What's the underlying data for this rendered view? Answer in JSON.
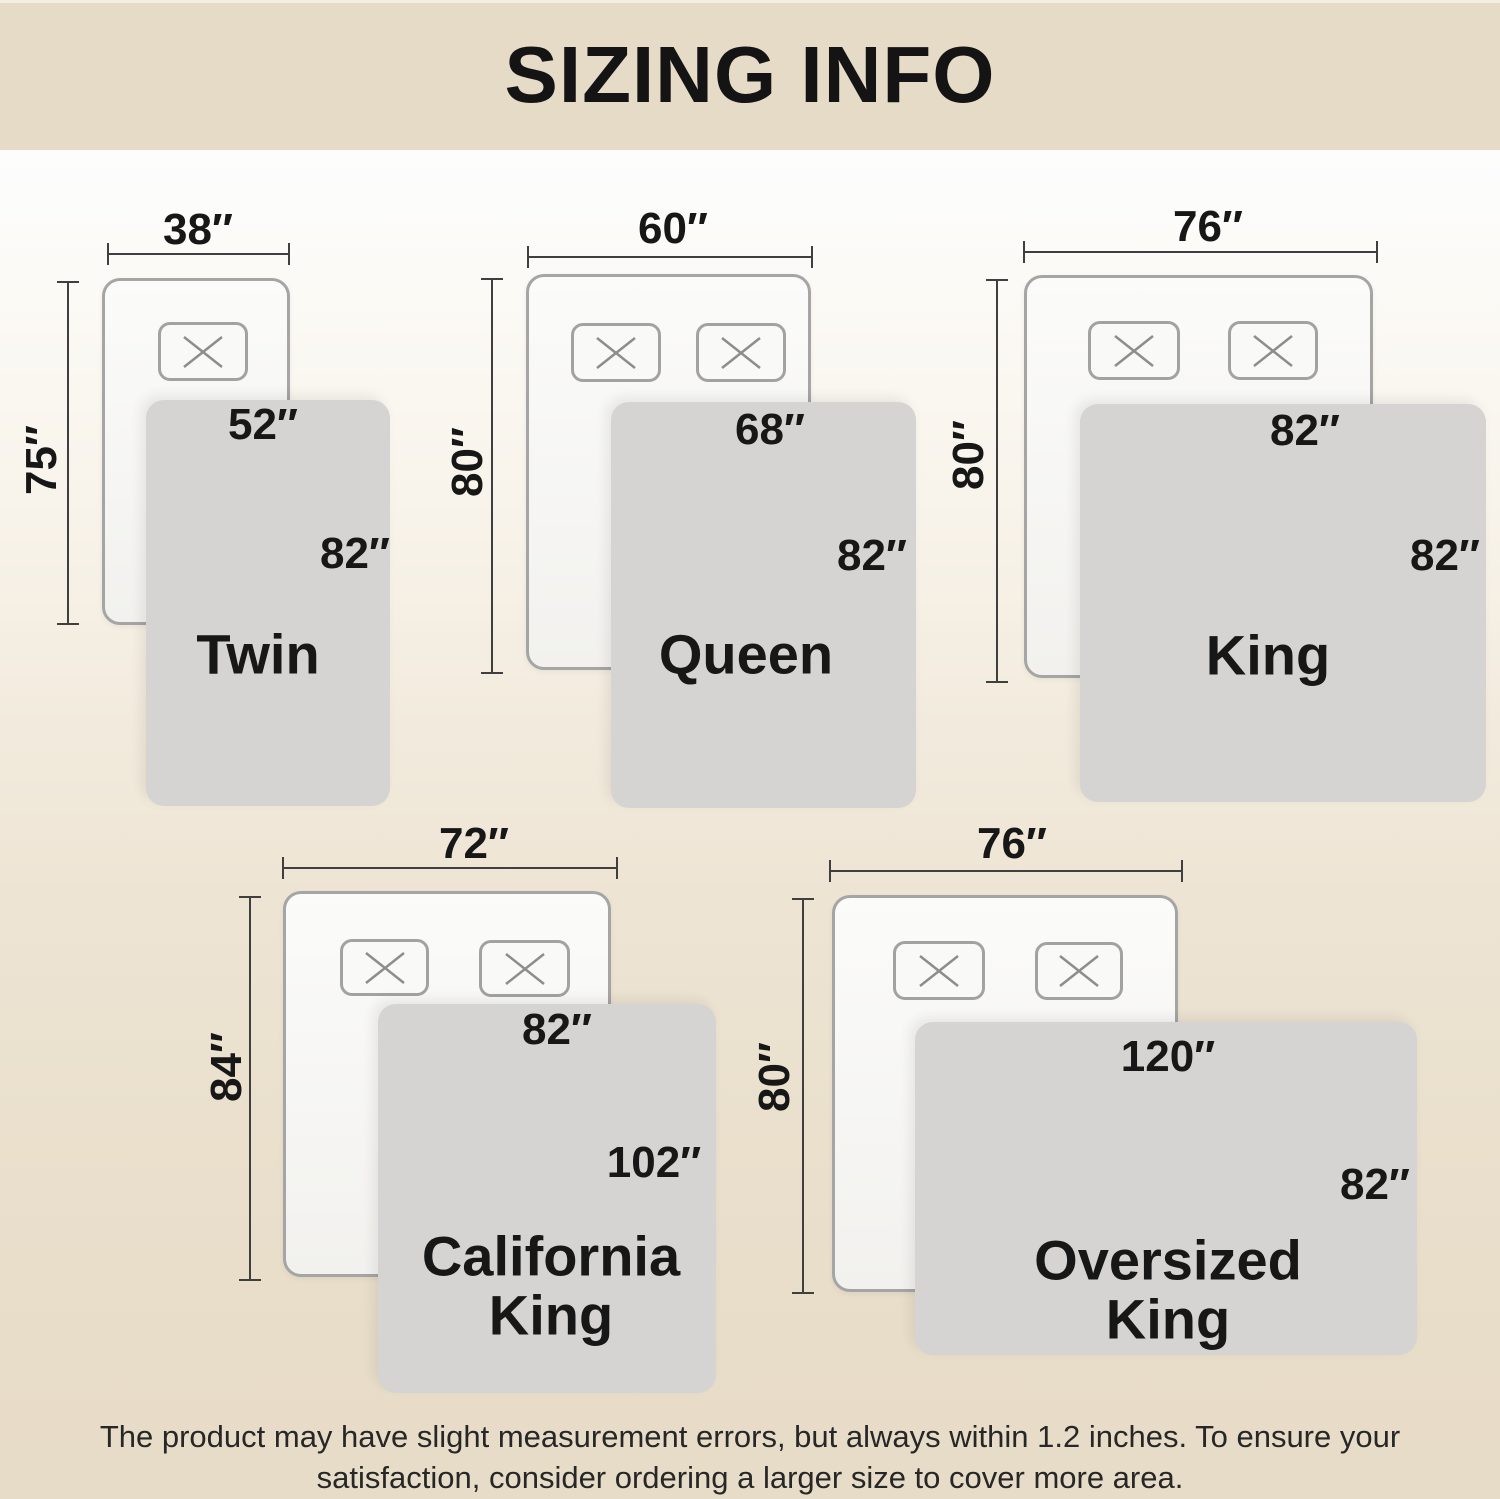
{
  "header": {
    "title": "SIZING INFO"
  },
  "footer": {
    "line1": "The product may have slight measurement errors, but always within 1.2 inches. To ensure your",
    "line2": "satisfaction, consider ordering a larger size to cover more area."
  },
  "sizes": [
    {
      "name": "Twin",
      "mattress_width": "38″",
      "mattress_length": "75″",
      "blanket_width": "52″",
      "blanket_length": "82″",
      "pillow_count": 1
    },
    {
      "name": "Queen",
      "mattress_width": "60″",
      "mattress_length": "80″",
      "blanket_width": "68″",
      "blanket_length": "82″",
      "pillow_count": 2
    },
    {
      "name": "King",
      "mattress_width": "76″",
      "mattress_length": "80″",
      "blanket_width": "82″",
      "blanket_length": "82″",
      "pillow_count": 2
    },
    {
      "name": "California King",
      "mattress_width": "72″",
      "mattress_length": "84″",
      "blanket_width": "82″",
      "blanket_length": "102″",
      "pillow_count": 2
    },
    {
      "name": "Oversized King",
      "mattress_width": "76″",
      "mattress_length": "80″",
      "blanket_width": "120″",
      "blanket_length": "82″",
      "pillow_count": 2
    }
  ],
  "colors": {
    "banner_bg": "#e5dbc7",
    "background_bottom": "#e7dcc8",
    "blanket": "#d5d4d2",
    "bed_border": "#a5a5a5",
    "dimension_line": "#3f3f3f",
    "text": "#171717"
  }
}
